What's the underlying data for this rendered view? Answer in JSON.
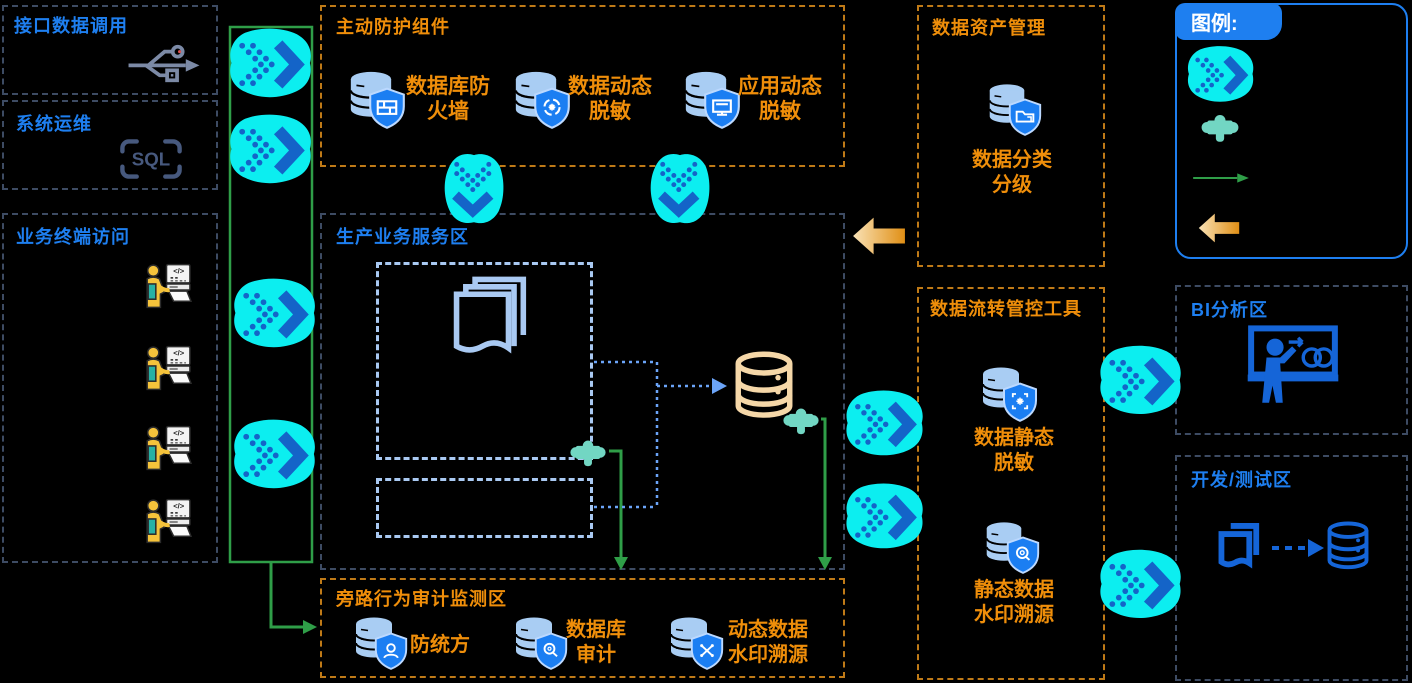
{
  "colors": {
    "background": "#000000",
    "blue_title": "#1e7ff0",
    "orange_label": "#ef8e0a",
    "orange_border": "#bf7a17",
    "dark_border": "#3d4b63",
    "inner_dashed": "#a9c9f2",
    "cyan_arrow": "#0ceef0",
    "chevron_blue": "#1464c8",
    "puzzle_teal": "#72d6c3",
    "green_line": "#2f9e48",
    "tan_db": "#f5d7a8",
    "shield_blue": "#1b7ef2",
    "db_fill": "#a9cdf3",
    "bi_blue": "#1565d8"
  },
  "zones": {
    "interface_call": {
      "title": "接口数据调用",
      "icon": "usb-icon"
    },
    "system_ops": {
      "title": "系统运维",
      "icon": "sql-icon",
      "sql_text": "SQL"
    },
    "terminal_access": {
      "title": "业务终端访问",
      "terminal_count": "4",
      "screen_text": "</>"
    },
    "protection": {
      "title": "主动防护组件",
      "items": [
        {
          "line1": "数据库防",
          "line2": "火墙",
          "icon": "db-shield-firewall-icon"
        },
        {
          "line1": "数据动态",
          "line2": "脱敏",
          "icon": "db-shield-refresh-icon"
        },
        {
          "line1": "应用动态",
          "line2": "脱敏",
          "icon": "db-shield-monitor-icon"
        }
      ]
    },
    "production": {
      "title": "生产业务服务区"
    },
    "audit": {
      "title": "旁路行为审计监测区",
      "items": [
        {
          "line1": "防统方",
          "line2": "",
          "icon": "db-shield-person-icon"
        },
        {
          "line1": "数据库",
          "line2": "审计",
          "icon": "db-shield-magnifier-icon"
        },
        {
          "line1": "动态数据",
          "line2": "水印溯源",
          "icon": "db-shield-cross-icon"
        }
      ]
    },
    "asset_mgmt": {
      "title": "数据资产管理",
      "item": {
        "line1": "数据分类",
        "line2": "分级",
        "icon": "db-shield-folder-icon"
      }
    },
    "flow_tools": {
      "title": "数据流转管控工具",
      "items": [
        {
          "line1": "数据静态",
          "line2": "脱敏",
          "icon": "db-shield-starframe-icon"
        },
        {
          "line1": "静态数据",
          "line2": "水印溯源",
          "icon": "db-shield-disksearch-icon"
        }
      ]
    },
    "bi": {
      "title": "BI分析区",
      "icon": "bi-presentation-icon"
    },
    "dev_test": {
      "title": "开发/测试区",
      "icons": [
        "document-icon",
        "database-icon"
      ]
    },
    "legend": {
      "title": "图例:",
      "items": [
        "flow-arrow-icon",
        "plugin-puzzle-icon",
        "green-arrow-icon",
        "orange-arrow-icon"
      ]
    }
  }
}
